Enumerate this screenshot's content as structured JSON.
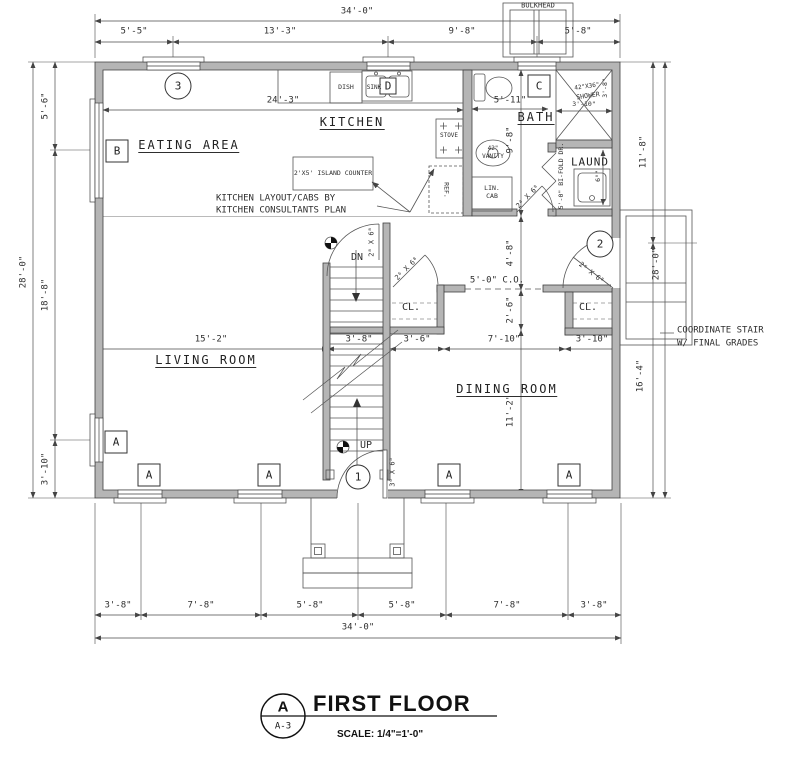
{
  "drawing": {
    "bulkhead": "BULKHEAD",
    "rooms": {
      "kitchen": "KITCHEN",
      "eating_area": "EATING AREA",
      "bath": "BATH",
      "laundry": "LAUND",
      "living_room": "LIVING ROOM",
      "dining_room": "DINING ROOM",
      "closet_left": "CL.",
      "closet_right": "CL."
    },
    "fixtures": {
      "dish": "DISH",
      "sink": "SINK",
      "stove": "STOVE",
      "fridge": "REF.",
      "vanity_size": "42\"",
      "vanity": "VANITY",
      "linen_1": "LIN.",
      "linen_2": "CAB",
      "shower_size": "42\"X36\"",
      "shower": "SHOWER",
      "island": "2'X5' ISLAND COUNTER"
    },
    "notes": {
      "kitchen_1": "KITCHEN LAYOUT/CABS BY",
      "kitchen_2": "KITCHEN CONSULTANTS PLAN",
      "stair_1": "COORDINATE STAIR",
      "stair_2": "W/ FINAL GRADES",
      "cased_opening": "5'-0\" C.O.",
      "bifold": "5'-0\" BI-FOLD DR.",
      "dn": "DN",
      "up": "UP"
    },
    "door_marks": {
      "d1": "1",
      "d2": "2",
      "d3": "3"
    },
    "door_sizes": {
      "front": "3⁰ X 6⁸",
      "mud": "2⁶ X 6⁸",
      "stair": "2⁸ X 6⁸",
      "closet": "2⁶ X 6⁸",
      "bath": "2⁴ X 6⁸"
    },
    "window_marks": {
      "a": "A",
      "b": "B",
      "c": "C",
      "d": "D"
    },
    "dims": {
      "top_overall": "34'-0\"",
      "top": [
        "5'-5\"",
        "13'-3\"",
        "9'-8\"",
        "5'-8\""
      ],
      "bottom": [
        "3'-8\"",
        "7'-8\"",
        "5'-8\"",
        "5'-8\"",
        "7'-8\"",
        "3'-8\""
      ],
      "bottom_overall": "34'-0\"",
      "left_overall": "28'-0\"",
      "left": [
        "5'-6\"",
        "18'-8\"",
        "3'-10\""
      ],
      "right": [
        "11'-8\"",
        "16'-4\""
      ],
      "right_overall": "28'-0\"",
      "mid": [
        "15'-2\"",
        "3'-8\"",
        "3'-6\"",
        "7'-10\"",
        "3'-10\""
      ],
      "interior_vertical": [
        "9'-8\"",
        "4'-8\"",
        "2'-6\"",
        "11'-2\""
      ],
      "kitchen_width": "24'-3\"",
      "bath_width": "5'-11\"",
      "shower_width": "3'-10\"",
      "shower_depth": "3'-8\"",
      "laundry_width": "6⁰\""
    }
  },
  "title_block": {
    "detail_letter": "A",
    "sheet_number": "A-3",
    "title": "FIRST FLOOR",
    "scale": "SCALE: 1/4\"=1'-0\""
  }
}
